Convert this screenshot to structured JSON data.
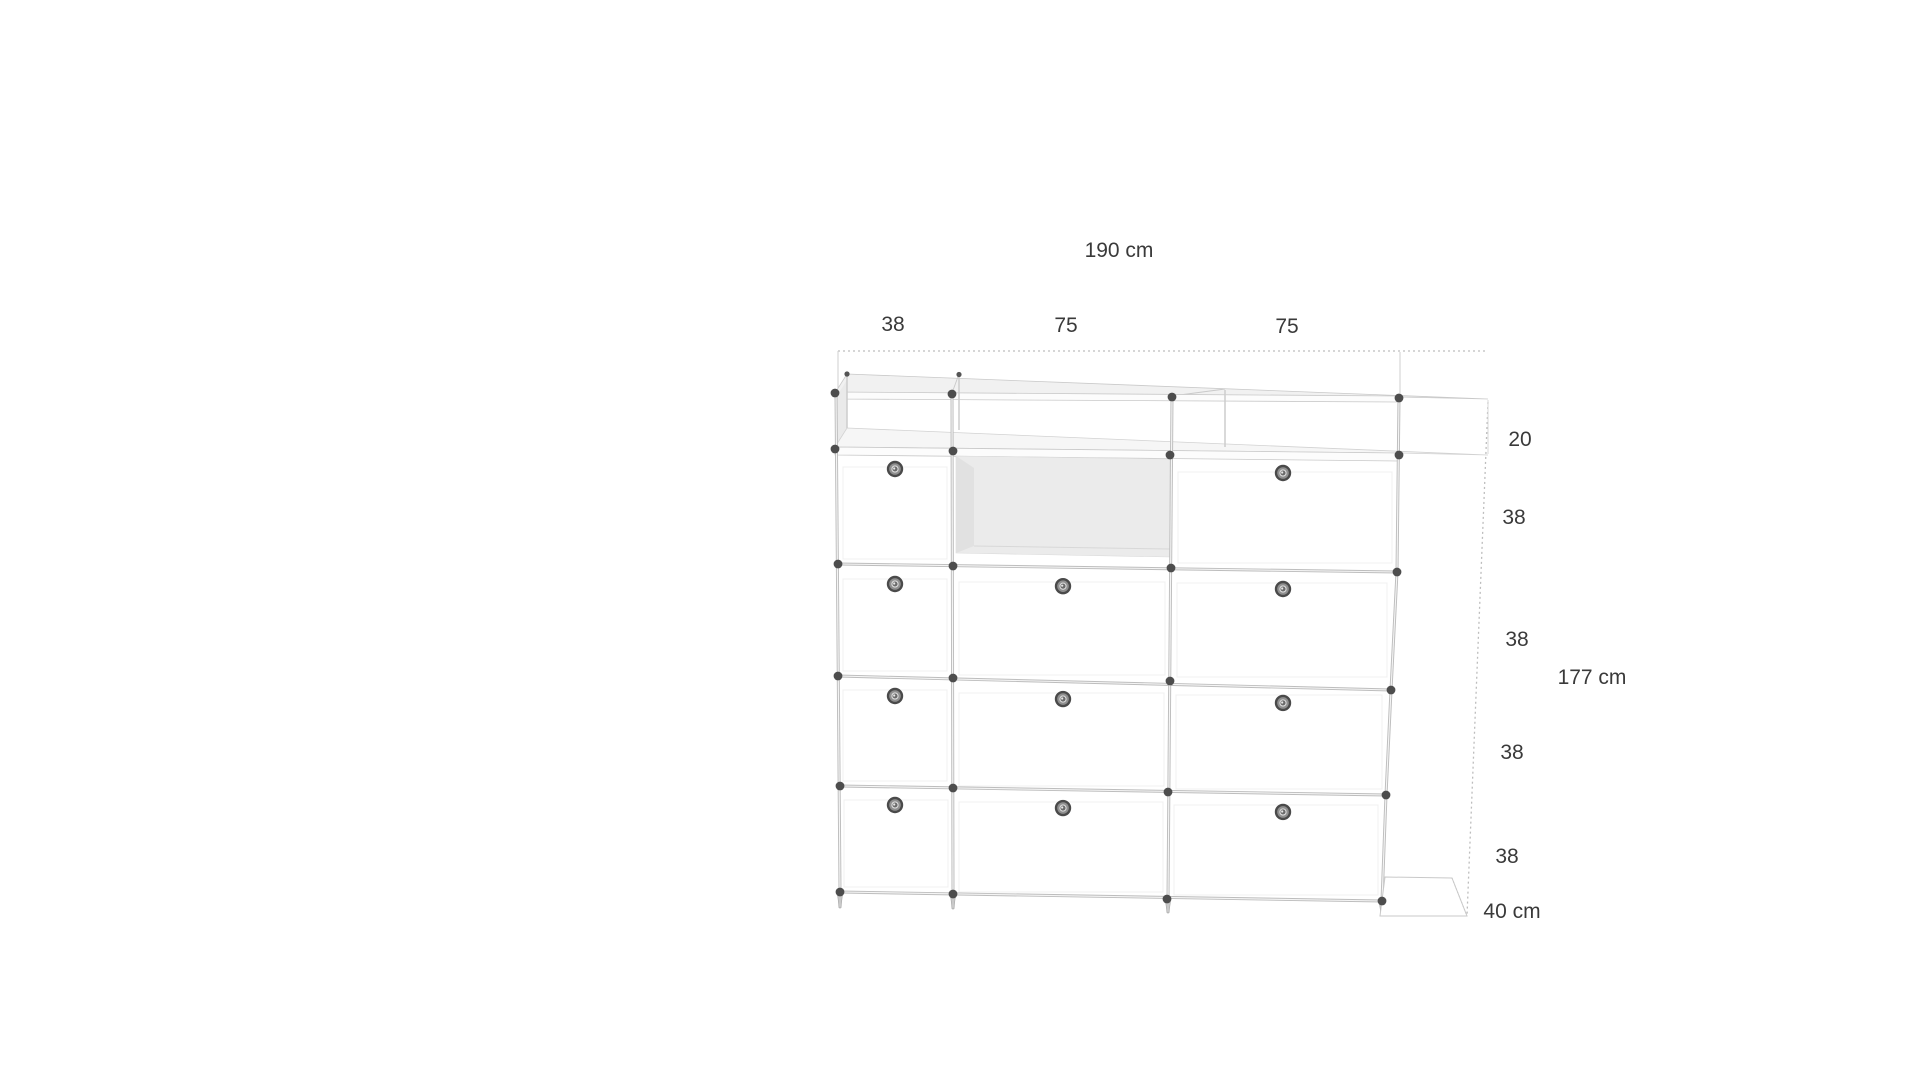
{
  "drawing": {
    "type": "furniture-dimension-diagram",
    "labels": {
      "total_width": "190 cm",
      "col_width_1": "38",
      "col_width_2": "75",
      "col_width_3": "75",
      "row_shelf": "20",
      "row_1": "38",
      "row_2": "38",
      "row_3": "38",
      "row_4": "38",
      "total_height": "177 cm",
      "depth": "40 cm"
    },
    "grid": {
      "columns": 3,
      "rows": 4,
      "cells": [
        [
          "lock",
          "open",
          "lock"
        ],
        [
          "lock",
          "lock",
          "lock"
        ],
        [
          "lock",
          "lock",
          "lock"
        ],
        [
          "lock",
          "lock",
          "lock"
        ]
      ]
    },
    "colors": {
      "frame_line": "#c6c6c6",
      "connector_ball": "#4d4d4d",
      "panel_top": "#f1f1f1",
      "open_cell": "#ebebeb",
      "dimension_line": "#bdbdbd",
      "text": "#3a3a3a",
      "background": "#ffffff"
    }
  }
}
